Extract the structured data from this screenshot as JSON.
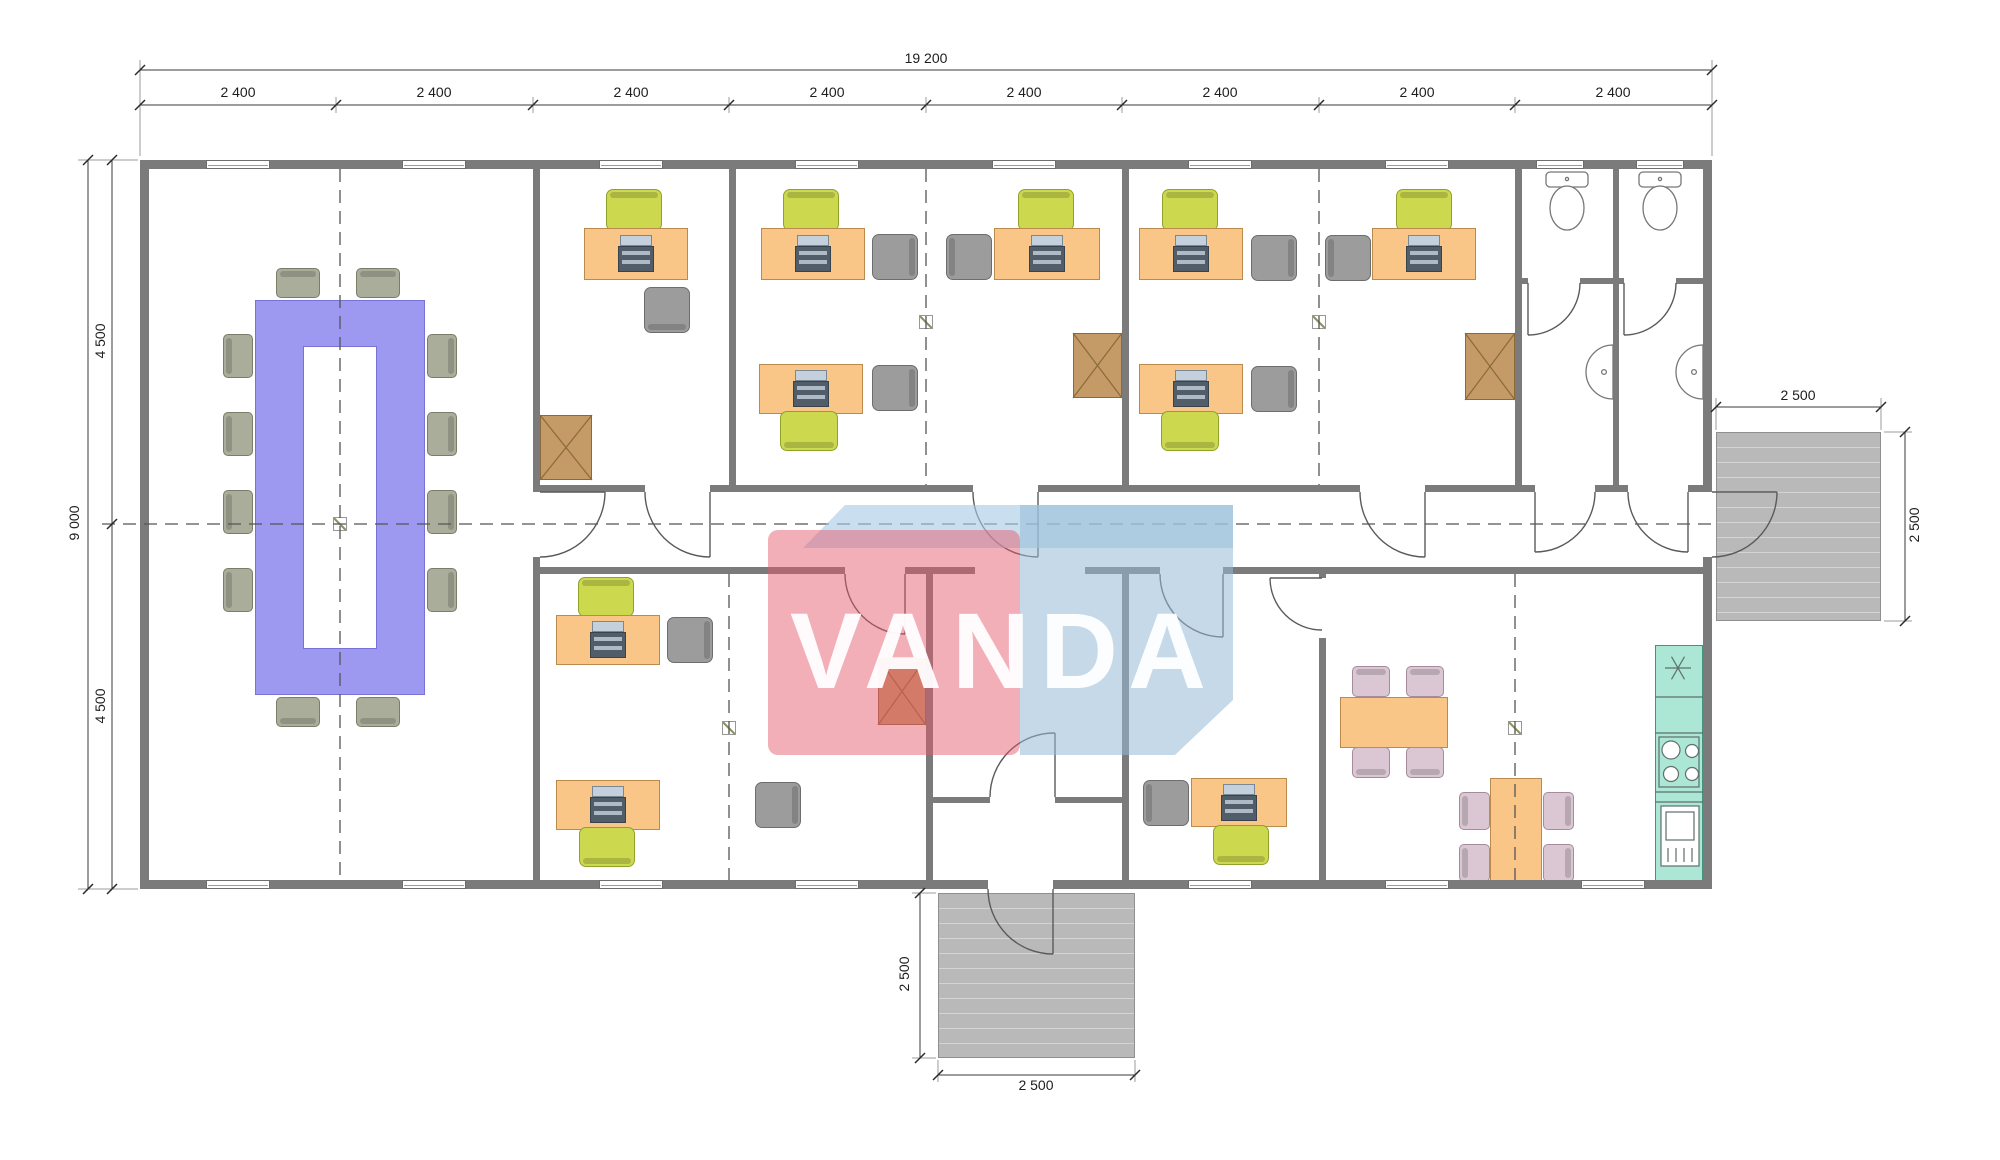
{
  "title": "office-module-floor-plan",
  "watermark": {
    "text": "VANDA",
    "red": "#e5576b",
    "blue": "#96bad6",
    "band": "#a8cce6"
  },
  "dimensions": {
    "total_width": "19 200",
    "bays": [
      "2 400",
      "2 400",
      "2 400",
      "2 400",
      "2 400",
      "2 400",
      "2 400",
      "2 400"
    ],
    "total_height": "9 000",
    "height_halves": [
      "4 500",
      "4 500"
    ],
    "right_entrance": {
      "width": "2 500",
      "depth": "2 500"
    },
    "bottom_entrance": {
      "width": "2 500",
      "depth": "2 500"
    }
  },
  "colors": {
    "wall": "#7b7b7b",
    "desk": "#f9c687",
    "task_chair": "#ccd94f",
    "guest_chair": "#9c9c9c",
    "conference_table": "#9d99f1",
    "conference_chair": "#abad9b",
    "cabinet": "#c49a67",
    "kitchen_counter": "#abe7d4",
    "cafe_chair": "#dbc7d3",
    "stairs": "#b9b9b9"
  }
}
